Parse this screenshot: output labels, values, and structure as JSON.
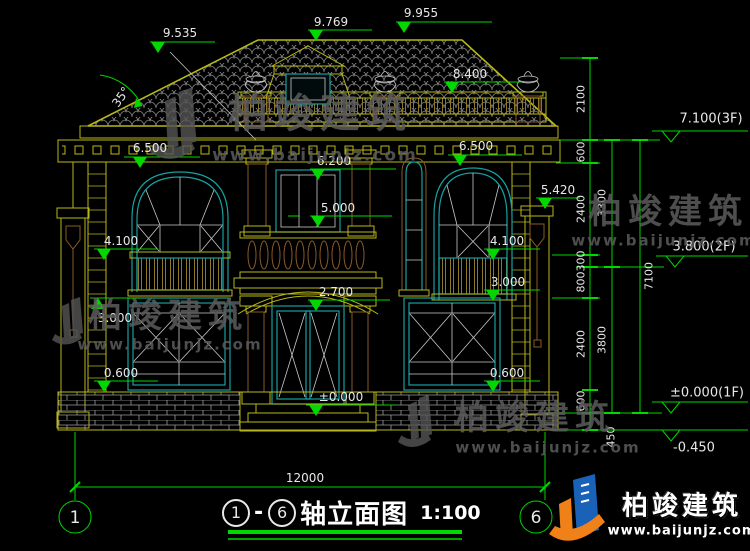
{
  "colors": {
    "line_yellow": "#b8b818",
    "line_teal": "#17a0a0",
    "line_brown": "#8a5a28",
    "dim_green": "#00d800",
    "text_white": "#e8e8e8",
    "watermark_gray": "#5c5c5c",
    "logo_orange": "#f08018",
    "logo_blue": "#1a62b8"
  },
  "elevation_markers": {
    "r9535": "9.535",
    "r9769": "9.769",
    "r9955": "9.955",
    "r8400": "8.400",
    "l6500": "6.500",
    "r6500": "6.500",
    "c6200": "6.200",
    "c5000": "5.000",
    "p5420": "5.420",
    "l4100": "4.100",
    "r4100": "4.100",
    "l3000": "3.000",
    "r3000": "3.000",
    "c2700": "2.700",
    "l0600": "0.600",
    "r0600": "0.600",
    "door0": "±0.000",
    "roof_angle": "35°"
  },
  "dim_chain": {
    "d2100": "2100",
    "d600a": "600",
    "d2400a": "2400",
    "d300": "300",
    "d800": "800",
    "d2400b": "2400",
    "d600b": "600",
    "d450": "450",
    "d3300": "3300",
    "d3800": "3800",
    "d7100": "7100"
  },
  "floor_levels": {
    "f3": "7.100(3F)",
    "f2": "3.800(2F)",
    "f1": "±0.000(1F)",
    "below": "-0.450"
  },
  "overall_dim": "12000",
  "axis_bubbles": {
    "left": "1",
    "right": "6"
  },
  "title_block": {
    "axis_from": "1",
    "dash": "-",
    "axis_to": "6",
    "name": "轴立面图",
    "scale": "1:100"
  },
  "watermark": {
    "brand": "柏竣建筑",
    "url": "www.baijunjz.com"
  },
  "logo": {
    "brand": "柏竣建筑",
    "url": "www.baijunjz.com"
  }
}
